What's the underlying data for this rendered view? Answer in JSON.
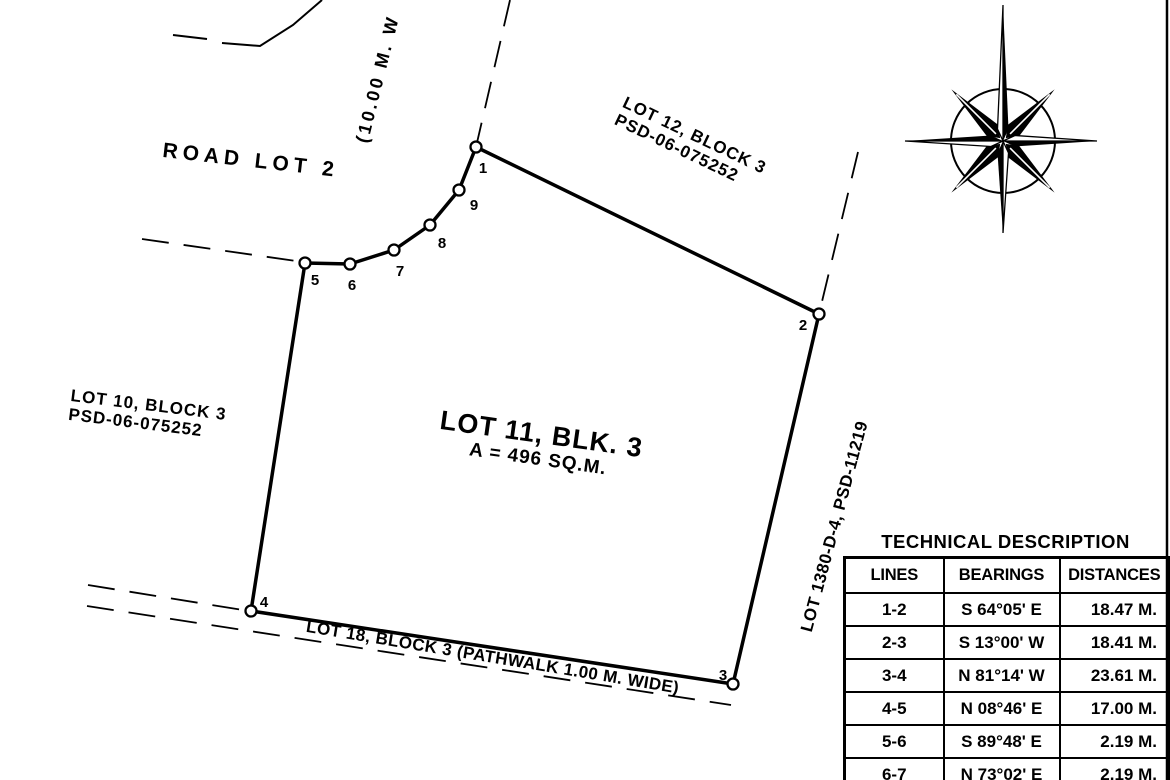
{
  "colors": {
    "ink": "#000000",
    "paper": "#ffffff"
  },
  "icons": {
    "compass": "compass-rose-icon"
  },
  "plan": {
    "road_label": "ROAD LOT 2",
    "road_width_label": "(10.00 M. W",
    "lot12_line1": "LOT 12, BLOCK 3",
    "lot12_line2": "PSD-06-075252",
    "lot10_line1": "LOT 10, BLOCK 3",
    "lot10_line2": "PSD-06-075252",
    "lot11_title": "LOT 11, BLK. 3",
    "lot11_area": "A = 496 SQ.M.",
    "lot18_label": "LOT 18, BLOCK 3 (PATHWALK 1.00 M. WIDE)",
    "lot1380_label": "LOT 1380-D-4, PSD-11219",
    "vertices": [
      {
        "label": "1"
      },
      {
        "label": "2"
      },
      {
        "label": "3"
      },
      {
        "label": "4"
      },
      {
        "label": "5"
      },
      {
        "label": "6"
      },
      {
        "label": "7"
      },
      {
        "label": "8"
      },
      {
        "label": "9"
      }
    ]
  },
  "table": {
    "title": "TECHNICAL DESCRIPTION",
    "headers": [
      "LINES",
      "BEARINGS",
      "DISTANCES"
    ],
    "rows": [
      [
        "1-2",
        "S 64°05' E",
        "18.47 M."
      ],
      [
        "2-3",
        "S 13°00' W",
        "18.41 M."
      ],
      [
        "3-4",
        "N 81°14' W",
        "23.61 M."
      ],
      [
        "4-5",
        "N 08°46' E",
        "17.00 M."
      ],
      [
        "5-6",
        "S 89°48' E",
        "2.19 M."
      ],
      [
        "6-7",
        "N 73°02' E",
        "2.19 M."
      ]
    ]
  }
}
